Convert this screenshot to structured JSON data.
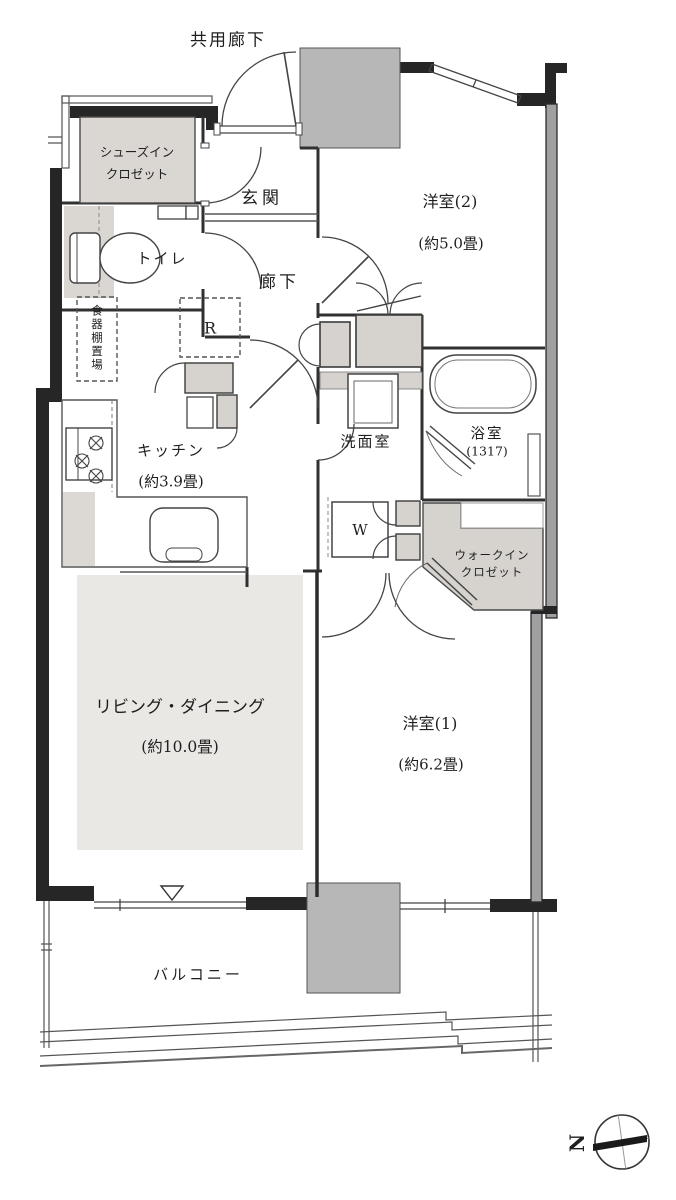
{
  "plan": {
    "common_corridor": "共用廊下",
    "rooms": {
      "shoes_in_closet": {
        "line1": "シューズイン",
        "line2": "クロゼット"
      },
      "entrance": {
        "label": "玄関"
      },
      "toilet": {
        "label": "トイレ"
      },
      "hallway": {
        "label": "廊下"
      },
      "western_room_2": {
        "label": "洋室(2)",
        "size": "(約5.0畳)"
      },
      "dish_shelf_space": {
        "label": "食器棚置場"
      },
      "kitchen": {
        "label": "キッチン",
        "size": "(約3.9畳)"
      },
      "washroom": {
        "label": "洗面室"
      },
      "bathroom": {
        "label": "浴室",
        "size": "(1317)"
      },
      "walk_in_closet": {
        "line1": "ウォークイン",
        "line2": "クロゼット"
      },
      "living_dining": {
        "label": "リビング・ダイニング",
        "size": "(約10.0畳)"
      },
      "western_room_1": {
        "label": "洋室(1)",
        "size": "(約6.2畳)"
      },
      "balcony": {
        "label": "バルコニー"
      }
    },
    "markers": {
      "refrigerator": "R",
      "washer": "W",
      "north": "N"
    },
    "colors": {
      "wall": "#262626",
      "line": "#3f3f3f",
      "pillar": "#b7b7b7",
      "closet": "#d6d3cf",
      "sic": "#dad7d3",
      "wic": "#d6d3cf",
      "living_shade": "#eae8e4",
      "right_wall": "#a0a0a0",
      "counter": "#dcd9d5"
    }
  }
}
